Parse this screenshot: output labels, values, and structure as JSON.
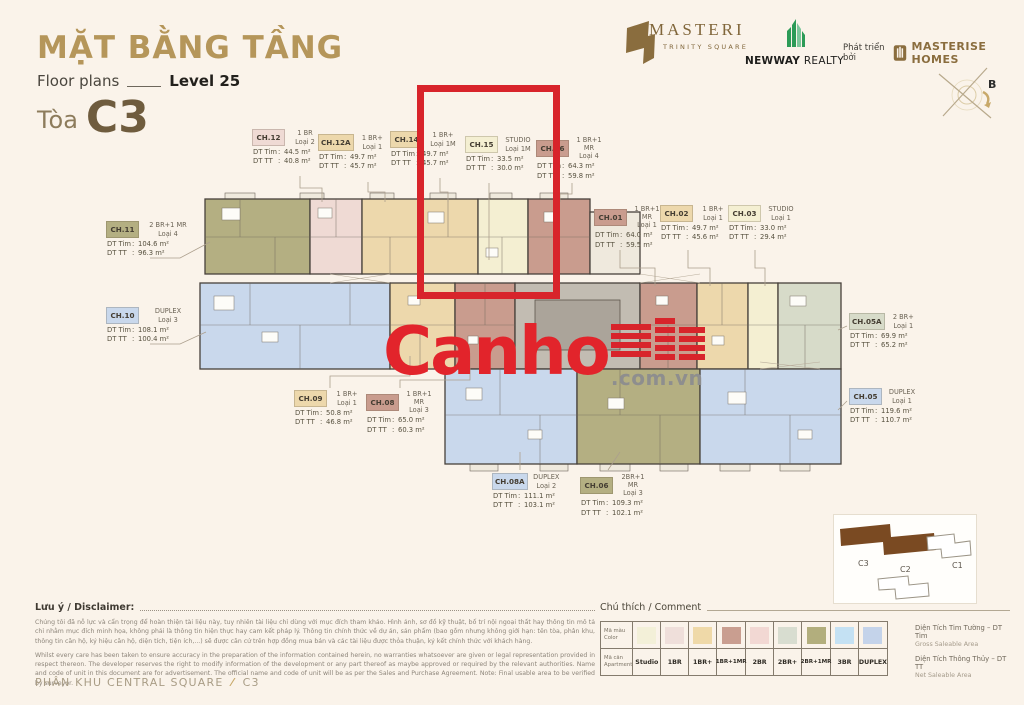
{
  "header": {
    "title": "MẶT BẰNG TẦNG",
    "floor_plans": "Floor plans",
    "level": "Level 25",
    "tower_prefix": "Tòa",
    "tower": "C3"
  },
  "logos": {
    "masteri": {
      "name": "MASTERI",
      "subtitle": "TRINITY SQUARE"
    },
    "newway": {
      "bold": "NEWWAY",
      "rest": " REALTY"
    },
    "masterise": {
      "developed_by": "Phát triển bởi",
      "name": "MASTERISE HOMES"
    }
  },
  "compass": {
    "north_label": "B"
  },
  "watermark": {
    "brand": "Canho",
    "suffix": ".com.vn"
  },
  "highlight_color": "#D8242B",
  "field_labels": {
    "dt_tim": "DT Tim",
    "dt_tt": "DT TT"
  },
  "units": [
    {
      "id": "CH.11",
      "type": "2 BR+1 MR",
      "variant": "Loại 4",
      "dt_tim": "104.6 m²",
      "dt_tt": "96.3 m²",
      "color": "#B4AF82"
    },
    {
      "id": "CH.12",
      "type": "1 BR",
      "variant": "Loại 2",
      "dt_tim": "44.5 m²",
      "dt_tt": "40.8 m²",
      "color": "#EFDAD4"
    },
    {
      "id": "CH.12A",
      "type": "1 BR+",
      "variant": "Loại 1",
      "dt_tim": "49.7 m²",
      "dt_tt": "45.7 m²",
      "color": "#EDD8AC"
    },
    {
      "id": "CH.14",
      "type": "1 BR+",
      "variant": "Loại 1M",
      "dt_tim": "49.7 m²",
      "dt_tt": "45.7 m²",
      "color": "#EDD8AC"
    },
    {
      "id": "CH.15",
      "type": "STUDIO",
      "variant": "Loại 1M",
      "dt_tim": "33.5 m²",
      "dt_tt": "30.0 m²",
      "color": "#F4EFD2"
    },
    {
      "id": "CH.16",
      "type": "1 BR+1 MR",
      "variant": "Loại 4",
      "dt_tim": "64.3 m²",
      "dt_tt": "59.8 m²",
      "color": "#C99C8E"
    },
    {
      "id": "CH.01",
      "type": "1 BR+1 MR",
      "variant": "Loại 1",
      "dt_tim": "64.0 m²",
      "dt_tt": "59.5 m²",
      "color": "#C99C8E"
    },
    {
      "id": "CH.02",
      "type": "1 BR+",
      "variant": "Loại 1",
      "dt_tim": "49.7 m²",
      "dt_tt": "45.6 m²",
      "color": "#EDD8AC"
    },
    {
      "id": "CH.03",
      "type": "STUDIO",
      "variant": "Loại 1",
      "dt_tim": "33.0 m²",
      "dt_tt": "29.4 m²",
      "color": "#F4EFD2"
    },
    {
      "id": "CH.05A",
      "type": "2 BR+",
      "variant": "Loại 1",
      "dt_tim": "69.9 m²",
      "dt_tt": "65.2 m²",
      "color": "#D7DBC9"
    },
    {
      "id": "CH.05",
      "type": "DUPLEX",
      "variant": "Loại 1",
      "dt_tim": "119.6 m²",
      "dt_tt": "110.7 m²",
      "color": "#C9D8EC"
    },
    {
      "id": "CH.10",
      "type": "DUPLEX",
      "variant": "Loại 3",
      "dt_tim": "108.1 m²",
      "dt_tt": "100.4 m²",
      "color": "#C9D8EC"
    },
    {
      "id": "CH.09",
      "type": "1 BR+",
      "variant": "Loại 1",
      "dt_tim": "50.8 m²",
      "dt_tt": "46.8 m²",
      "color": "#EDD8AC"
    },
    {
      "id": "CH.08",
      "type": "1 BR+1 MR",
      "variant": "Loại 3",
      "dt_tim": "65.0 m²",
      "dt_tt": "60.3 m²",
      "color": "#C99C8E"
    },
    {
      "id": "CH.08A",
      "type": "DUPLEX",
      "variant": "Loại 2",
      "dt_tim": "111.1 m²",
      "dt_tt": "103.1 m²",
      "color": "#C9D8EC"
    },
    {
      "id": "CH.06",
      "type": "2BR+1 MR",
      "variant": "Loại 3",
      "dt_tim": "109.3 m²",
      "dt_tt": "102.1 m²",
      "color": "#B4AF82"
    }
  ],
  "plan": {
    "core_color": "#C2BCB2",
    "core_inner_color": "#ABA49A",
    "wall_color": "#47413b"
  },
  "legend": {
    "heading": "Chú thích / Comment",
    "color_row_label": "Mã màu",
    "color_row_sub": "Color",
    "apt_row_label": "Mã căn",
    "apt_row_sub": "Apartment",
    "items": [
      {
        "label": "Studio",
        "color": "#F3F0D8"
      },
      {
        "label": "1BR",
        "color": "#EFDFDA"
      },
      {
        "label": "1BR+",
        "color": "#EFD9A8"
      },
      {
        "label": "1BR+1MR",
        "color": "#C99E90"
      },
      {
        "label": "2BR",
        "color": "#F2D8D3"
      },
      {
        "label": "2BR+",
        "color": "#D8DDD0"
      },
      {
        "label": "2BR+1MR",
        "color": "#B2AE7D"
      },
      {
        "label": "3BR",
        "color": "#C4E1F3"
      },
      {
        "label": "DUPLEX",
        "color": "#C4D3EA"
      }
    ],
    "notes": [
      {
        "main": "Diện Tích Tim Tường – DT Tim",
        "sub": "Gross Saleable Area"
      },
      {
        "main": "Diện Tích Thông Thủy – DT TT",
        "sub": "Net Saleable Area"
      }
    ]
  },
  "site_map": {
    "highlighted": "C3",
    "highlight_fill": "#7A4A22",
    "buildings": [
      "C3",
      "C1",
      "C2"
    ]
  },
  "disclaimer": {
    "heading": "Lưu ý / Disclaimer:",
    "vi": "Chúng tôi đã nỗ lực và cẩn trọng để hoàn thiện tài liệu này, tuy nhiên tài liệu chỉ dùng với mục đích tham khảo. Hình ảnh, sơ đồ kỹ thuật, bố trí nội ngoại thất hay thông tin mô tả chỉ nhằm mục đích minh họa, không phải là thông tin hiện thực hay cam kết pháp lý. Thông tin chính thức về dự án, sản phẩm (bao gồm nhưng không giới hạn: tên tòa, phân khu, thông tin căn hộ, ký hiệu căn hộ, diện tích, tiện ích,...) sẽ được căn cứ trên hợp đồng mua bán và các tài liệu được thỏa thuận, ký kết chính thức với khách hàng.",
    "en": "Whilst every care has been taken to ensure accuracy in the preparation of the information contained herein, no warranties whatsoever are given or legal representation provided in respect thereon. The developer reserves the right to modify information of the development or any part thereof as maybe approved or required by the relevant authorities. Name and code of unit in this document are for advertisement. The official name and code of unit will be as per the Sales and Purchase Agreement. Note: Final usable area to be verified by surveyor."
  },
  "footer": {
    "zone": "PHÂN KHU CENTRAL SQUARE",
    "separator": "⁄",
    "tower": "C3"
  }
}
